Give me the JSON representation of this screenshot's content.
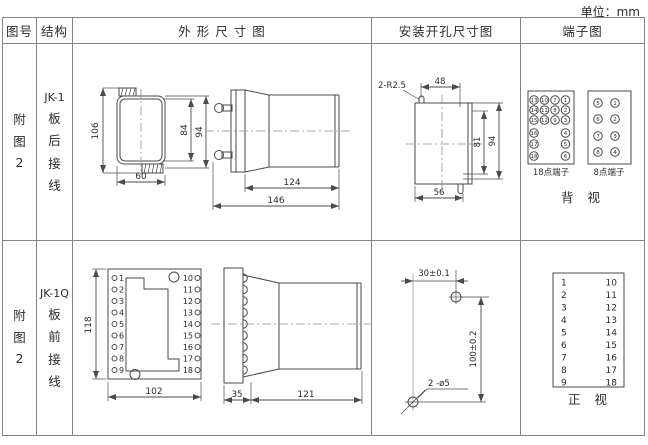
{
  "unit": "单位：mm",
  "headers": {
    "fig_no": "图号",
    "structure": "结构",
    "outline": "外 形 尺 寸 图",
    "install": "安装开孔尺寸图",
    "terminal": "端子图"
  },
  "row1": {
    "fig": {
      "c1": "附",
      "c2": "图",
      "c3": "2"
    },
    "structure": {
      "c1": "JK-1",
      "c2": "板",
      "c3": "后",
      "c4": "接",
      "c5": "线"
    },
    "front": {
      "h106": "106",
      "h84": "84",
      "h94": "94",
      "w60": "60"
    },
    "side": {
      "l124": "124",
      "l146": "146"
    },
    "install": {
      "slot": "2-R2.5",
      "w48": "48",
      "h81": "81",
      "h94": "94",
      "w56": "56"
    },
    "t18": {
      "label": "18点端子",
      "g": [
        [
          "13",
          "10",
          "7",
          "1"
        ],
        [
          "14",
          "11",
          "8",
          "2"
        ],
        [
          "15",
          "12",
          "9",
          "3"
        ],
        [
          "16",
          "4"
        ],
        [
          "17",
          "5"
        ],
        [
          "18",
          "6"
        ]
      ]
    },
    "t8": {
      "label": "8点端子",
      "g": [
        [
          "5",
          "1"
        ],
        [
          "6",
          "2"
        ],
        [
          "7",
          "3"
        ],
        [
          "8",
          "4"
        ]
      ]
    },
    "view": "背 视"
  },
  "row2": {
    "fig": {
      "c1": "附",
      "c2": "图",
      "c3": "2"
    },
    "structure": {
      "c1": "JK-1Q",
      "c2": "板",
      "c3": "前",
      "c4": "接",
      "c5": "线"
    },
    "front": {
      "h118": "118",
      "w102": "102",
      "left": [
        "1",
        "2",
        "3",
        "4",
        "5",
        "6",
        "7",
        "8",
        "9"
      ],
      "right": [
        "10",
        "11",
        "12",
        "13",
        "14",
        "15",
        "16",
        "17",
        "18"
      ]
    },
    "side": {
      "d35": "35",
      "l121": "121"
    },
    "install": {
      "h30": "30±0.1",
      "v100": "100±0.2",
      "holes": "2 -ø5"
    },
    "tbox": {
      "left": [
        "1",
        "2",
        "3",
        "4",
        "5",
        "6",
        "7",
        "8",
        "9"
      ],
      "right": [
        "10",
        "11",
        "12",
        "13",
        "14",
        "15",
        "16",
        "17",
        "18"
      ]
    },
    "view": "正 视"
  }
}
